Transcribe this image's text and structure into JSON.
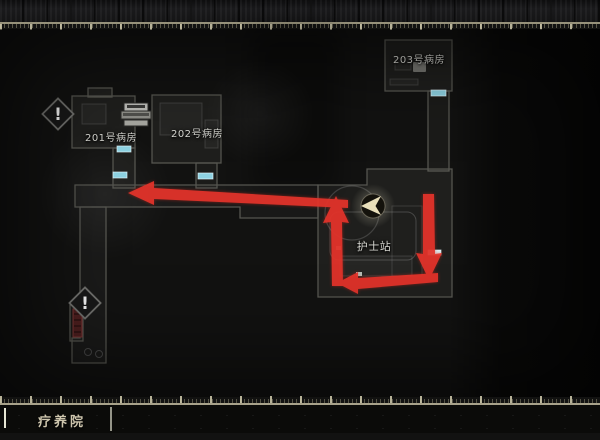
{
  "map": {
    "floor_label": "疗养院",
    "rooms": [
      {
        "id": "room-201",
        "label": "201号病房"
      },
      {
        "id": "room-202",
        "label": "202号病房"
      },
      {
        "id": "room-203",
        "label": "203号病房"
      },
      {
        "id": "nurse-station",
        "label": "护士站"
      }
    ],
    "markers": [
      {
        "name": "exclamation-marker-upper",
        "glyph": "!"
      },
      {
        "name": "exclamation-marker-lower",
        "glyph": "!"
      },
      {
        "name": "player-marker"
      },
      {
        "name": "item-box-icon"
      }
    ],
    "doors": {
      "count": 5
    }
  },
  "colors": {
    "route": "#e2332a",
    "door": "#8ed2e2",
    "door_bright": "#d6edf2",
    "player": "#e9dfba",
    "red_door": "#4e1f1f"
  }
}
